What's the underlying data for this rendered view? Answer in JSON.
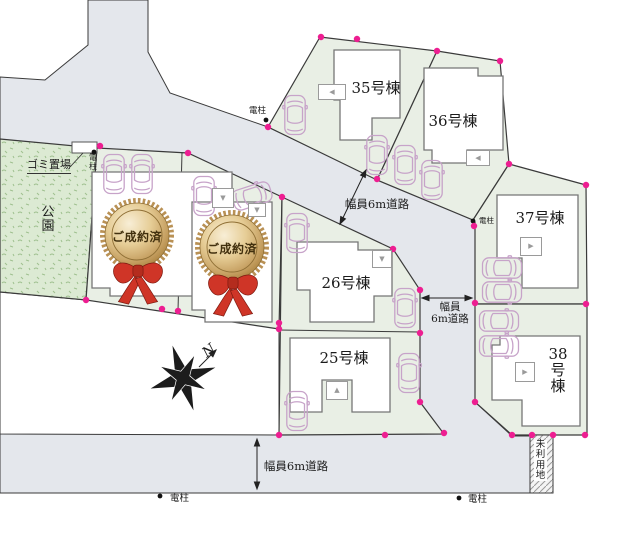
{
  "lots": {
    "lot35": "35号棟",
    "lot36": "36号棟",
    "lot37": "37号棟",
    "lot38": "38号棟",
    "lot26": "26号棟",
    "lot25": "25号棟"
  },
  "sold_badge": {
    "label": "ご成約済"
  },
  "road_labels": {
    "width_6m": "幅員6m道路",
    "width_6m_line1": "幅員",
    "width_6m_line2": "6m道路"
  },
  "landmarks": {
    "park": "公園",
    "garbage_station": "ゴミ置場",
    "unused_land": "未利用地",
    "utility_pole": "電柱",
    "north_mark": "N"
  },
  "icons": {
    "entrance_up": "▲",
    "entrance_down": "▼",
    "entrance_left": "◀",
    "entrance_right": "▶"
  },
  "colors": {
    "road": "#e4e7ec",
    "lot": "#e9efe5",
    "park": "#dcead3",
    "boundary_dot": "#ed1e91",
    "car_outline": "#c7a3c9",
    "badge_gold": "#d9b878",
    "ribbon_red": "#cf3527",
    "outline": "#3a3a3a"
  }
}
